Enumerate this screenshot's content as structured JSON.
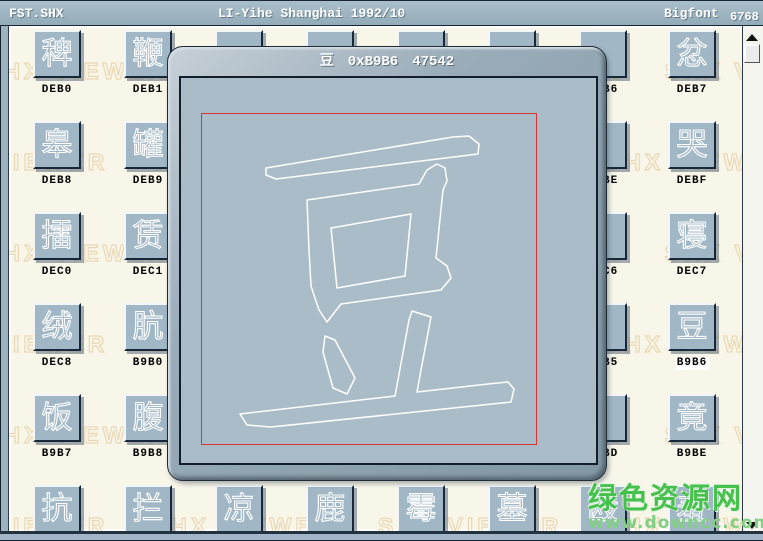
{
  "titlebar": {
    "file_name": "FST.SHX",
    "font_info": "LI-Yihe Shanghai 1992/10",
    "font_type": "Bigfont",
    "glyph_count": "6768"
  },
  "dialog": {
    "char": "豆",
    "hex_code": "0xB9B6",
    "decimal_code": "47542"
  },
  "grid": {
    "rows": [
      [
        {
          "char": "稗",
          "label": "DEB0"
        },
        {
          "char": "鞭",
          "label": "DEB1"
        },
        {
          "char": "",
          "label": ""
        },
        {
          "char": "",
          "label": ""
        },
        {
          "char": "",
          "label": ""
        },
        {
          "char": "",
          "label": ""
        },
        {
          "char": "",
          "label": "DEB6"
        },
        {
          "char": "忿",
          "label": "DEB7"
        }
      ],
      [
        {
          "char": "皋",
          "label": "DEB8"
        },
        {
          "char": "罐",
          "label": "DEB9"
        },
        {
          "char": "",
          "label": ""
        },
        {
          "char": "",
          "label": ""
        },
        {
          "char": "",
          "label": ""
        },
        {
          "char": "",
          "label": ""
        },
        {
          "char": "",
          "label": "DEBE"
        },
        {
          "char": "哭",
          "label": "DEBF"
        }
      ],
      [
        {
          "char": "擂",
          "label": "DEC0"
        },
        {
          "char": "赁",
          "label": "DEC1"
        },
        {
          "char": "",
          "label": ""
        },
        {
          "char": "",
          "label": ""
        },
        {
          "char": "",
          "label": ""
        },
        {
          "char": "",
          "label": ""
        },
        {
          "char": "",
          "label": "DEC6"
        },
        {
          "char": "寝",
          "label": "DEC7"
        }
      ],
      [
        {
          "char": "绒",
          "label": "DEC8"
        },
        {
          "char": "肮",
          "label": "B9B0"
        },
        {
          "char": "",
          "label": ""
        },
        {
          "char": "",
          "label": ""
        },
        {
          "char": "",
          "label": ""
        },
        {
          "char": "",
          "label": ""
        },
        {
          "char": "",
          "label": "B9B5"
        },
        {
          "char": "豆",
          "label": "B9B6",
          "selected": true
        }
      ],
      [
        {
          "char": "饭",
          "label": "B9B7"
        },
        {
          "char": "腹",
          "label": "B9B8"
        },
        {
          "char": "",
          "label": ""
        },
        {
          "char": "",
          "label": ""
        },
        {
          "char": "",
          "label": ""
        },
        {
          "char": "",
          "label": ""
        },
        {
          "char": "",
          "label": "B9BD"
        },
        {
          "char": "竟",
          "label": "B9BE"
        }
      ],
      [
        {
          "char": "抗",
          "label": ""
        },
        {
          "char": "拦",
          "label": ""
        },
        {
          "char": "凉",
          "label": ""
        },
        {
          "char": "鹿",
          "label": ""
        },
        {
          "char": "霉",
          "label": ""
        },
        {
          "char": "墓",
          "label": ""
        },
        {
          "char": "殴",
          "label": ""
        },
        {
          "char": "羞",
          "label": ""
        }
      ]
    ]
  },
  "watermark": {
    "repeated_text": "SHX VIEWER",
    "site_name": "绿色资源网",
    "site_url": "www.downcc.com"
  },
  "colors": {
    "frame": "#9db3c0",
    "background": "#f8f5e9",
    "tile_face": "#a1b7c5",
    "dialog_canvas": "#a9bcc8",
    "grid_box_red": "#d93535",
    "watermark_green": "#46c14e"
  }
}
